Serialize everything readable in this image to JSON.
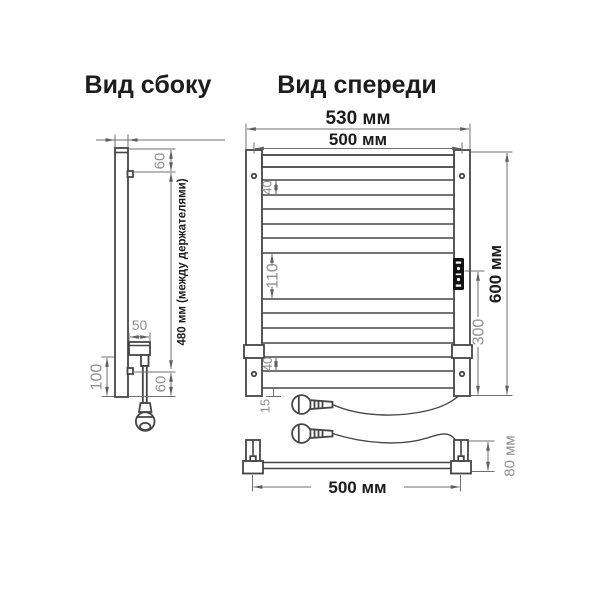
{
  "titles": {
    "side": "Вид сбоку",
    "front": "Вид спереди"
  },
  "side_view": {
    "dims": {
      "holder_offset_top_mm": "60",
      "between_holders": "480 мм (между держателями)",
      "heater_block_depth_mm": "50",
      "lower_section_mm": "100",
      "holder_offset_bottom_mm": "60"
    }
  },
  "front_view": {
    "dims": {
      "overall_width": "530 мм",
      "rail_width": "500 мм",
      "top_rung_gap_mm": "40",
      "middle_gap_mm": "110",
      "bottom_rung_gap_mm": "40",
      "bottom_offset_mm": "15",
      "heater_zone_mm": "300",
      "overall_height": "600 мм"
    }
  },
  "top_view": {
    "dims": {
      "rail_width": "500 мм",
      "depth": "80 мм"
    }
  },
  "colors": {
    "ink": "#454545",
    "dim_line": "#6f6f6f",
    "dim_text": "#8f8f8f",
    "label_text": "#1c1c1c",
    "panel": "#111111",
    "background": "#ffffff"
  }
}
